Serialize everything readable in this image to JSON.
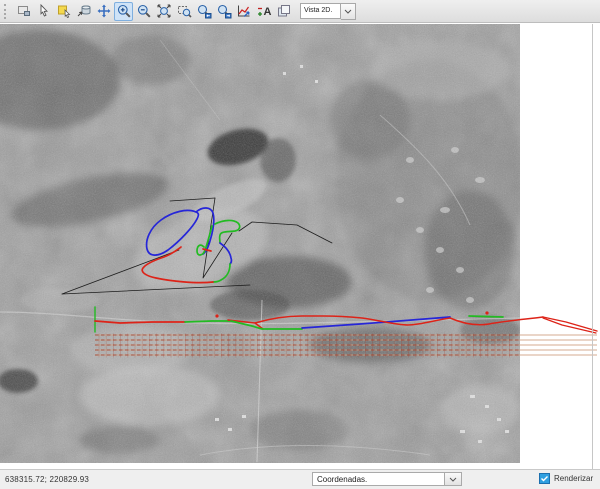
{
  "toolbar": {
    "view_selector": {
      "value": "Vista 2D."
    },
    "icons": [
      "new-view-icon",
      "select-cursor-icon",
      "select-area-icon",
      "clear-data-icon",
      "pan-icon",
      "zoom-in-icon",
      "zoom-out-icon",
      "zoom-extent-icon",
      "zoom-selection-icon",
      "zoom-previous-icon",
      "zoom-next-icon",
      "profile-chart-icon",
      "text-size-icon",
      "copy-view-icon"
    ],
    "active_tool": "zoom-in"
  },
  "statusbar": {
    "coordinates": "638315.72; 220829.93",
    "mode_selector": {
      "value": "Coordenadas."
    },
    "render": {
      "label": "Renderizar",
      "checked": true
    }
  },
  "overlay": {
    "colors": {
      "red": "#dd2318",
      "green": "#22bb22",
      "blue": "#2626d8",
      "black": "#1c1c1c",
      "guide_base": "#cf9d7e",
      "guide_dash": "#a8402a",
      "guide_tick": "#a83c28",
      "dot": "#dd2318"
    },
    "guide_rows_y": [
      335,
      340,
      345,
      350,
      355
    ],
    "guide_x_range": [
      95,
      597
    ],
    "photo_right_edge": 520,
    "paths": [
      {
        "name": "tangent-1",
        "color": "#1c1c1c",
        "w": 0.8,
        "d": "M215,198 L203,278 L232,233"
      },
      {
        "name": "tangent-2",
        "color": "#1c1c1c",
        "w": 0.8,
        "d": "M170,201 L215,198"
      },
      {
        "name": "tangent-3",
        "color": "#1c1c1c",
        "w": 0.8,
        "d": "M62,294 L250,285"
      },
      {
        "name": "tangent-4",
        "color": "#1c1c1c",
        "w": 0.8,
        "d": "M62,294 L179,250"
      },
      {
        "name": "tangent-5",
        "color": "#1c1c1c",
        "w": 0.8,
        "d": "M239,231 L252,222 L297,225 L332,243"
      },
      {
        "name": "blue-loop",
        "color": "#2626d8",
        "w": 1.7,
        "d": "M196,212 C187,208 172,212 161,220 C150,228 145,240 147,249 C149,257 158,257 168,250 C180,241 193,227 197,219 C199,215 199,213 196,212"
      },
      {
        "name": "blue-ramp",
        "color": "#2626d8",
        "w": 1.7,
        "d": "M196,212 C203,206 211,207 213,213 C215,220 213,231 210,241 C208,248 206,252 203,254"
      },
      {
        "name": "green-hairpin",
        "color": "#22bb22",
        "w": 1.7,
        "d": "M212,226 C209,237 207,245 205,250 C203,256 197,257 197,251 C197,246 200,243 204,247"
      },
      {
        "name": "red-joint",
        "color": "#dd2318",
        "w": 1.7,
        "d": "M203,249 L211,251"
      },
      {
        "name": "green-c",
        "color": "#22bb22",
        "w": 1.7,
        "d": "M215,224 C223,220 233,219 238,223 C241,226 240,230 235,231 C228,232 221,231 220,235 C219,238 220,240 220,243"
      },
      {
        "name": "blue-descender",
        "color": "#2626d8",
        "w": 1.7,
        "d": "M220,243 C226,247 230,252 231,258 C232,261 231,263 230,264"
      },
      {
        "name": "green-hook",
        "color": "#22bb22",
        "w": 1.7,
        "d": "M230,264 C230,271 227,277 221,280 C218,282 215,282 213,282"
      },
      {
        "name": "red-loop",
        "color": "#dd2318",
        "w": 1.7,
        "d": "M213,282 C196,284 170,281 156,278 C146,276 140,272 143,268 C146,264 155,260 164,257 C172,254 177,250 181,247"
      },
      {
        "name": "green-start-tick",
        "color": "#22bb22",
        "w": 1.4,
        "d": "M95,307 L95,332"
      },
      {
        "name": "red-a",
        "color": "#dd2318",
        "w": 1.7,
        "d": "M95,321 L120,323 L152,322 L185,322"
      },
      {
        "name": "green-a",
        "color": "#22bb22",
        "w": 1.7,
        "d": "M185,322 L212,321 L231,321"
      },
      {
        "name": "red-b",
        "color": "#dd2318",
        "w": 1.5,
        "d": "M228,320 L255,323 L263,329"
      },
      {
        "name": "green-b",
        "color": "#22bb22",
        "w": 1.7,
        "d": "M231,321 L252,326 L262,329 L302,329"
      },
      {
        "name": "blue-a",
        "color": "#2626d8",
        "w": 1.7,
        "d": "M302,328 L360,324 L412,320 L450,317"
      },
      {
        "name": "red-c",
        "color": "#dd2318",
        "w": 1.5,
        "d": "M255,323 C272,318 287,316 302,316 L323,316 C340,316 352,317 362,318 C378,320 396,325 408,325 C420,325 436,320 450,318 C464,324 477,326 489,324 C505,321 528,319 543,317"
      },
      {
        "name": "green-c2",
        "color": "#22bb22",
        "w": 1.7,
        "d": "M469,316 L503,317"
      },
      {
        "name": "red-d1",
        "color": "#dd2318",
        "w": 1.4,
        "d": "M543,317 L566,322 L597,331"
      },
      {
        "name": "red-d2",
        "color": "#dd2318",
        "w": 1.2,
        "d": "M543,318 L562,325 L596,333"
      }
    ],
    "dots": [
      {
        "x": 217,
        "y": 316
      },
      {
        "x": 487,
        "y": 313
      }
    ]
  }
}
